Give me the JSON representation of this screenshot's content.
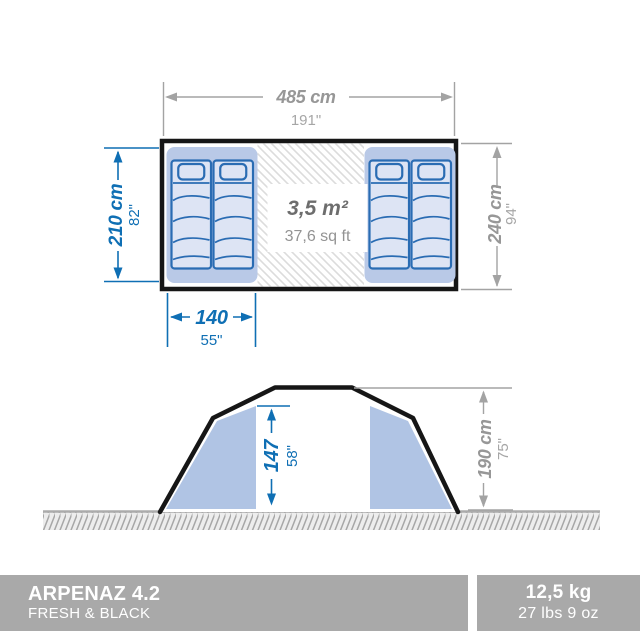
{
  "product": {
    "name": "ARPENAZ 4.2",
    "variant": "FRESH & BLACK",
    "weight_metric": "12,5 kg",
    "weight_imperial": "27 lbs 9 oz"
  },
  "floor_plan": {
    "width_metric": "485 cm",
    "width_imperial": "191\"",
    "depth_metric": "240 cm",
    "depth_imperial": "94\"",
    "cabin_length_metric": "210 cm",
    "cabin_length_imperial": "82\"",
    "cabin_width_metric": "140",
    "cabin_width_imperial": "55\"",
    "living_area_metric": "3,5 m²",
    "living_area_imperial": "37,6 sq ft"
  },
  "elevation": {
    "interior_height_metric": "147",
    "interior_height_imperial": "58\"",
    "total_height_metric": "190 cm",
    "total_height_imperial": "75\""
  },
  "colors": {
    "dimension_blue": "#0f6fb4",
    "dimension_gray": "#9e9e9e",
    "pad_blue": "#b9c9e7",
    "mattress_fill": "#dde4f4",
    "mattress_stroke": "#2a6cb3",
    "tent_outline_black": "#161616",
    "bar_gray": "#a9a9a9"
  }
}
